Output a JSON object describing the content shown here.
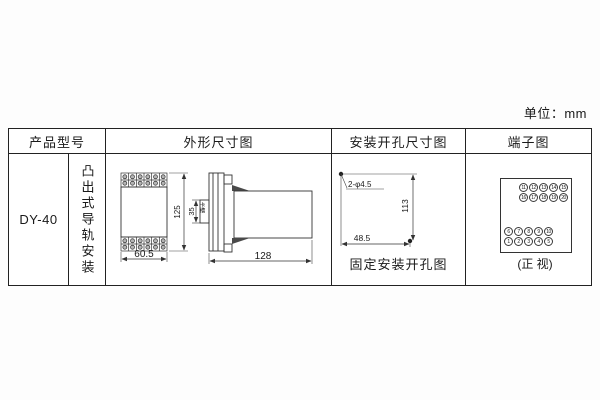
{
  "unit_label": "单位：mm",
  "table": {
    "headers": {
      "product_model": "产品型号",
      "outline": "外形尺寸图",
      "mounting_holes": "安装开孔尺寸图",
      "terminals": "端子图"
    },
    "product_model": "DY-40",
    "mounting_type": "凸出式导轨安装",
    "outline": {
      "width": "60.5",
      "height": "125",
      "slot_height": "35",
      "slot_label": "卡槽",
      "depth": "128"
    },
    "mounting_holes": {
      "hole_spec": "2-φ4.5",
      "vertical_spacing": "113",
      "horizontal_spacing": "48.5",
      "caption": "固定安装开孔图"
    },
    "terminals": {
      "top_rows": [
        [
          "11",
          "12",
          "13",
          "14",
          "15"
        ],
        [
          "16",
          "17",
          "18",
          "19",
          "20"
        ]
      ],
      "bottom_rows": [
        [
          "6",
          "7",
          "8",
          "9",
          "10"
        ],
        [
          "1",
          "2",
          "3",
          "4",
          "5"
        ]
      ],
      "caption": "(正 视)"
    }
  }
}
